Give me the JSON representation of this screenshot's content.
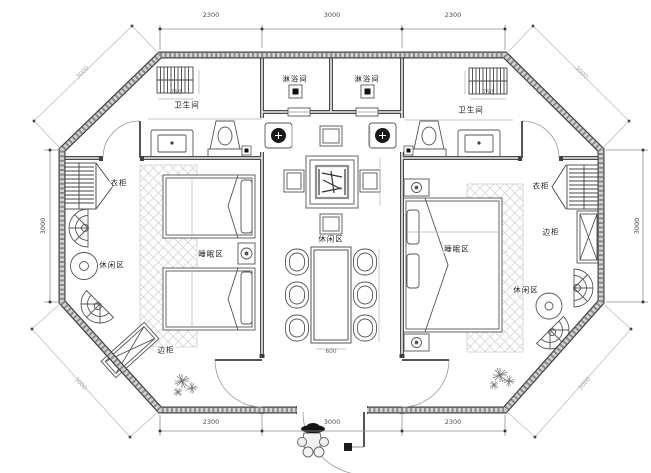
{
  "labels": {
    "shower_left": "淋浴间",
    "shower_right": "淋浴间",
    "bath_left": "卫生间",
    "bath_right": "卫生间",
    "wardrobe_left": "衣柜",
    "wardrobe_right": "衣柜",
    "sleep_left": "睡眠区",
    "sleep_right": "睡眠区",
    "leisure_left": "休闲区",
    "leisure_center": "休闲区",
    "leisure_right": "休闲区",
    "cabinet_left": "边柜",
    "cabinet_right": "边柜"
  },
  "dims": {
    "top_left": "2300",
    "top_mid": "3000",
    "top_right": "2300",
    "bottom_left": "2300",
    "bottom_mid": "3000",
    "bottom_right": "2300",
    "side_left": "3000",
    "side_right": "3000",
    "diag_tl": "3000",
    "diag_tr": "3000",
    "diag_bl": "3000",
    "diag_br": "3000",
    "towel_left": "750",
    "towel_right": "750",
    "table_w": "600"
  },
  "colors": {
    "wall": "#4a4a4a",
    "wall_fill": "#d4d4d4",
    "line": "#444444",
    "dim_line": "#8f8f8f",
    "hatch": "#d0d0d0",
    "background": "#ffffff"
  }
}
